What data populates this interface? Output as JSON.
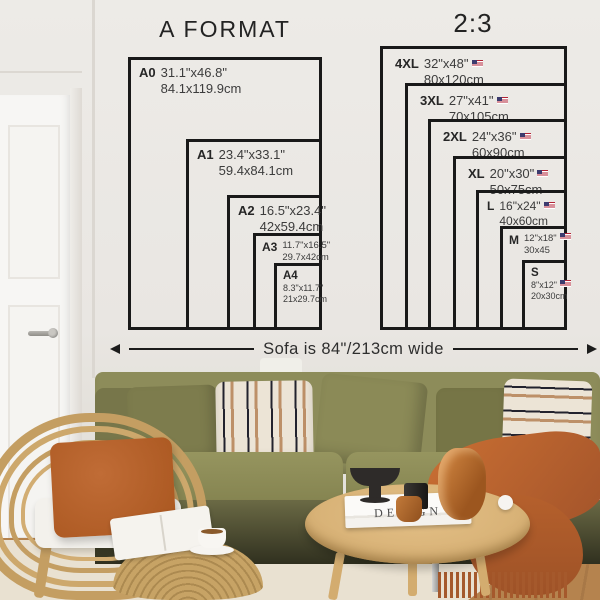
{
  "titles": {
    "a_format": "A FORMAT",
    "ratio": "2:3"
  },
  "a_format": {
    "sizes": [
      {
        "code": "A0",
        "inches": "31.1\"x46.8\"",
        "cm": "84.1x119.9cm"
      },
      {
        "code": "A1",
        "inches": "23.4\"x33.1\"",
        "cm": "59.4x84.1cm"
      },
      {
        "code": "A2",
        "inches": "16.5\"x23.4\"",
        "cm": "42x59.4cm"
      },
      {
        "code": "A3",
        "inches": "11.7\"x16.5\"",
        "cm": "29.7x42cm"
      },
      {
        "code": "A4",
        "inches": "8.3\"x11.7\"",
        "cm": "21x29.7cm"
      }
    ]
  },
  "ratio_2_3": {
    "sizes": [
      {
        "code": "4XL",
        "inches": "32\"x48\"",
        "cm": "80x120cm",
        "flag": "us-flag-icon"
      },
      {
        "code": "3XL",
        "inches": "27\"x41\"",
        "cm": "70x105cm",
        "flag": "us-flag-icon"
      },
      {
        "code": "2XL",
        "inches": "24\"x36\"",
        "cm": "60x90cm",
        "flag": "us-flag-icon"
      },
      {
        "code": "XL",
        "inches": "20\"x30\"",
        "cm": "50x75cm",
        "flag": "us-flag-icon"
      },
      {
        "code": "L",
        "inches": "16\"x24\"",
        "cm": "40x60cm",
        "flag": "us-flag-icon"
      },
      {
        "code": "M",
        "inches": "12\"x18\"",
        "cm": "30x45",
        "flag": "us-flag-icon"
      },
      {
        "code": "S",
        "inches": "8\"x12\"",
        "cm": "20x30cm",
        "flag": "us-flag-icon"
      }
    ]
  },
  "sofa_note": "Sofa is 84\"/213cm wide",
  "decor": {
    "book_title": "DESIGN"
  },
  "colors": {
    "diagram_line": "#191919",
    "wall": "#e9e6e2",
    "sofa_green": "#8d8c5a",
    "rust_orange": "#b5602c",
    "rattan": "#c49e62",
    "flag_red": "#b22234",
    "flag_blue": "#3c3b6e"
  }
}
